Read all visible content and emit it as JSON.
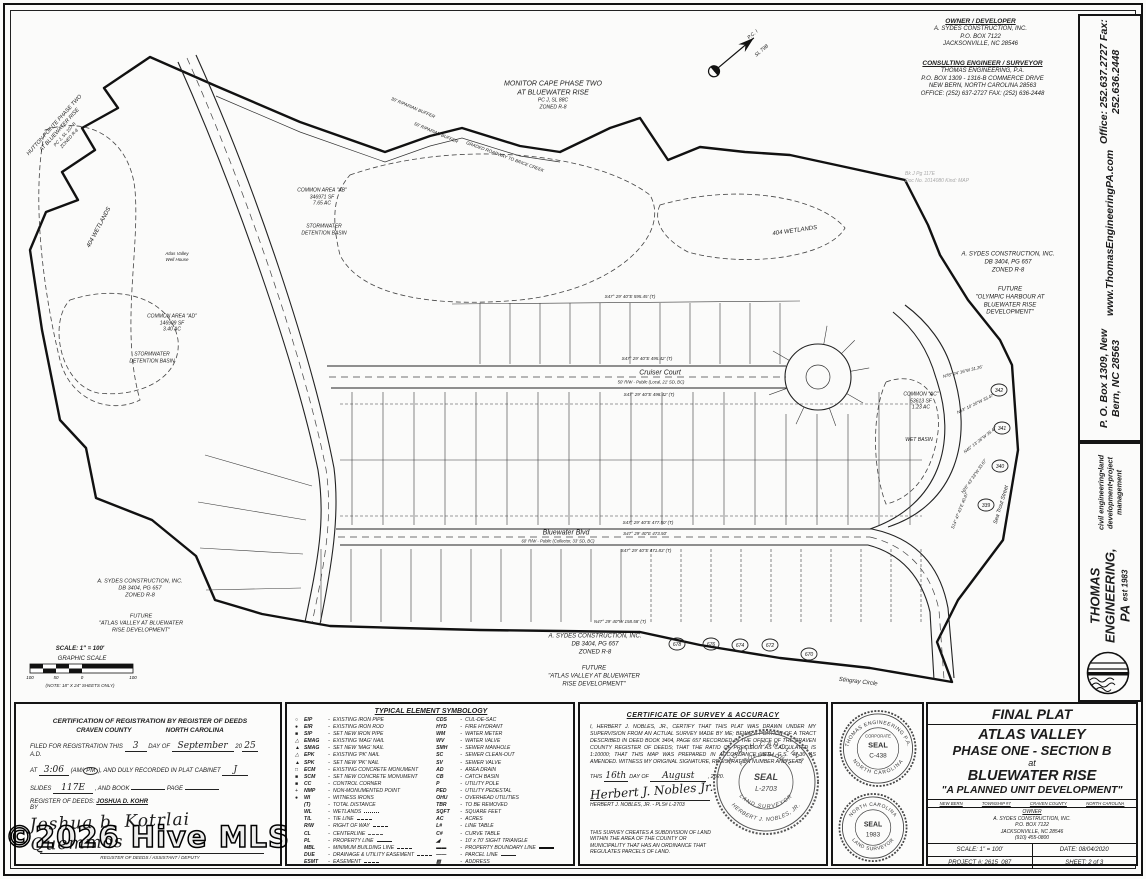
{
  "colors": {
    "ink": "#1c1c1c",
    "paper": "#fbfbfa",
    "faint": "#a9a9a9"
  },
  "watermark": "©2026 Hive MLS",
  "header": {
    "owner": {
      "heading": "OWNER / DEVELOPER",
      "lines": [
        "A. SYDES CONSTRUCTION, INC.",
        "P.O. BOX 7122",
        "JACKSONVILLE, NC 28546"
      ]
    },
    "engineer": {
      "heading": "CONSULTING ENGINEER / SURVEYOR",
      "lines": [
        "THOMAS ENGINEERING, P.A.",
        "P.O. BOX 1309 - 1316-B COMMERCE DRIVE",
        "NEW BERN, NORTH CAROLINA 28563",
        "OFFICE: (252) 637-2727   FAX: (252) 636-2448"
      ]
    },
    "stamp": {
      "line1": "Bk  J          Pg  117E",
      "line2": "Doc No. 1014080  Kind: MAP"
    }
  },
  "map": {
    "adjoiners": {
      "hutton": [
        "HUTTON POINTE PHASE TWO",
        "AT BLUEWATER RISE",
        "PC J, SL 107 B",
        "ZONED R-8"
      ],
      "monitor": [
        "MONITOR CAPE PHASE TWO",
        "AT BLUEWATER RISE",
        "PC J, SL 88C",
        "ZONED R-8"
      ]
    },
    "labels": {
      "wetlands": "404 WETLANDS",
      "common_ab": [
        "COMMON AREA \"AB\"",
        "346971 SF",
        "7.65 AC"
      ],
      "common_ad": [
        "COMMON AREA \"AD\"",
        "146909 SF",
        "3.40 AC"
      ],
      "common_ac": [
        "COMMON \"AC\"",
        "53613 SF",
        "1.23 AC"
      ],
      "stormwater": [
        "STORMWATER",
        "DETENTION BASIN"
      ],
      "wet_basin": "WET BASIN",
      "well_house": [
        "Atlas Valley",
        "Well House"
      ],
      "sydes": [
        "A. SYDES CONSTRUCTION, INC.",
        "DB 3404, PG 657",
        "ZONED R-8"
      ],
      "future_atlas": [
        "FUTURE",
        "\"ATLAS VALLEY AT BLUEWATER",
        "RISE DEVELOPMENT\""
      ],
      "future_olympic": [
        "FUTURE",
        "\"OLYMPIC HARBOUR AT",
        "BLUEWATER RISE",
        "DEVELOPMENT\""
      ],
      "riparian30": "30' RIPARIAN BUFFER",
      "riparian50": "50' RIPARIAN BUFFER",
      "brice": "GRADED ROADWAY TO BRICE CREEK",
      "pc": "P.C. I",
      "sl": "SL 79B"
    },
    "streets": {
      "cruiser": {
        "name": "Cruiser Court",
        "rw": "50' R/W - Public (Local, 21' SD, BC)",
        "bearing_top": "S47° 29' 40\"E   495.42' (T)",
        "bearing_bottom": "S47° 29' 40\"E   498.42' (T)"
      },
      "bluewater": {
        "name": "Bluewater Blvd",
        "rw": "60' R/W - Public (Collector, 33' SD, BC)",
        "bearing_top": "S47° 29' 40\"E   477.50' (T)",
        "bearing_mid": "S47° 29' 40\"E   473.50'",
        "bearing_bottom": "S47° 29' 40\"E   471.83' (T)"
      },
      "sea_trout": "Sea Trout Street",
      "stingray": "Stingray Circle"
    },
    "bearings": {
      "top_band": "S47° 29' 40\"E   595.45' (T)",
      "bottom_band": "N47° 29' 40\"W   158.58' (T)",
      "curve": [
        {
          "t": "N78° 24' 16\"W  31.26'",
          "x": 963,
          "y": 373,
          "r": -14
        },
        {
          "t": "N63° 10' 20\"W  33.47'",
          "x": 976,
          "y": 405,
          "r": -26
        },
        {
          "t": "N45° 13' 26\"W  35.47'",
          "x": 981,
          "y": 441,
          "r": -38
        },
        {
          "t": "N26° 43' 33\"W  33.67'",
          "x": 975,
          "y": 477,
          "r": -55
        },
        {
          "t": "S14° 47' 43\"E  40.87'",
          "x": 961,
          "y": 511,
          "r": -68
        }
      ]
    },
    "lots": {
      "right_curve": [
        {
          "n": "342",
          "x": 999,
          "y": 390
        },
        {
          "n": "341",
          "x": 1002,
          "y": 428
        },
        {
          "n": "340",
          "x": 1000,
          "y": 466
        },
        {
          "n": "339",
          "x": 986,
          "y": 505
        }
      ],
      "bottom_row": [
        {
          "n": "678",
          "x": 677,
          "y": 644
        },
        {
          "n": "676",
          "x": 711,
          "y": 644
        },
        {
          "n": "674",
          "x": 740,
          "y": 645
        },
        {
          "n": "672",
          "x": 770,
          "y": 645
        },
        {
          "n": "670",
          "x": 809,
          "y": 654
        }
      ]
    },
    "scale": {
      "text": "SCALE: 1\" = 100'",
      "caption": "GRAPHIC SCALE",
      "ticks": [
        "100",
        "50",
        "0",
        "100"
      ],
      "note": "(NOTE: 18\" X 24\" SHEETS ONLY)"
    }
  },
  "sidebar": {
    "contact": [
      "P. O. Box 1309, New Bern, NC  28563",
      "www.ThomasEngineeringPA.com",
      "Office:  252.637.2727   Fax:  252.636.2448"
    ],
    "firm": {
      "name": "THOMAS ENGINEERING, PA",
      "est": "est 1983",
      "tagline": "civil engineering•land development•project management"
    }
  },
  "registration": {
    "title": "CERTIFICATION OF REGISTRATION BY REGISTER OF DEEDS",
    "county": "CRAVEN COUNTY",
    "state": "NORTH CAROLINA",
    "filed_pre": "FILED FOR REGISTRATION THIS",
    "day": "3",
    "filed_mid": "DAY OF",
    "month": "September",
    "year_pre": "20",
    "year": "25",
    "ad": "A.D.",
    "at_label": "AT",
    "time": "3:06",
    "am": "AM",
    "pm": "PM",
    "recorded": "AND DULY RECORDED IN PLAT CABINET",
    "cabinet": "J",
    "slides_label": "SLIDES",
    "slides": "117E",
    "book_label": ", AND BOOK",
    "page_label": "PAGE",
    "rod_label": "REGISTER OF DEEDS:",
    "rod_name": "JOSHUA D. KOHR",
    "by": "BY",
    "signature": "Joshua b. Kotrlai Quemmos",
    "sig_caption": "REGISTER OF DEEDS / ASSISTANT / DEPUTY"
  },
  "legend": {
    "title": "TYPICAL ELEMENT SYMBOLOGY",
    "left": [
      {
        "sym": "○",
        "abbr": "EIP",
        "desc": "EXISTING IRON PIPE"
      },
      {
        "sym": "●",
        "abbr": "EIR",
        "desc": "EXISTING IRON ROD"
      },
      {
        "sym": "■",
        "abbr": "SIP",
        "desc": "SET NEW IRON PIPE"
      },
      {
        "sym": "△",
        "abbr": "EMAG",
        "desc": "EXISTING 'MAG' NAIL"
      },
      {
        "sym": "▲",
        "abbr": "SMAG",
        "desc": "SET NEW 'MAG' NAIL"
      },
      {
        "sym": "△",
        "abbr": "EPK",
        "desc": "EXISTING 'PK' NAIL"
      },
      {
        "sym": "▲",
        "abbr": "SPK",
        "desc": "SET NEW 'PK' NAIL"
      },
      {
        "sym": "□",
        "abbr": "ECM",
        "desc": "EXISTING CONCRETE MONUMENT"
      },
      {
        "sym": "■",
        "abbr": "SCM",
        "desc": "SET NEW CONCRETE MONUMENT"
      },
      {
        "sym": "■",
        "abbr": "CC",
        "desc": "CONTROL CORNER"
      },
      {
        "sym": "+",
        "abbr": "NMP",
        "desc": "NON-MONUMENTED POINT"
      },
      {
        "sym": "●",
        "abbr": "WI",
        "desc": "WITNESS IRONS"
      },
      {
        "sym": "",
        "abbr": "(T)",
        "desc": "TOTAL DISTANCE"
      },
      {
        "sym": "",
        "abbr": "WL",
        "desc": "WETLANDS",
        "ls": "dotted"
      },
      {
        "sym": "",
        "abbr": "T/L",
        "desc": "TIE LINE",
        "ls": "dashed"
      },
      {
        "sym": "",
        "abbr": "R/W",
        "desc": "RIGHT OF WAY",
        "ls": "dashed"
      },
      {
        "sym": "",
        "abbr": "CL",
        "desc": "CENTERLINE",
        "ls": "dashdot"
      },
      {
        "sym": "",
        "abbr": "PL",
        "desc": "PROPERTY LINE",
        "ls": "solid"
      },
      {
        "sym": "",
        "abbr": "MBL",
        "desc": "MINIMUM BUILDING LINE",
        "ls": "dashed"
      },
      {
        "sym": "",
        "abbr": "DUE",
        "desc": "DRAINAGE & UTILITY EASEMENT",
        "ls": "dashed"
      },
      {
        "sym": "",
        "abbr": "ESMT",
        "desc": "EASEMENT",
        "ls": "dashed"
      }
    ],
    "right": [
      {
        "abbr": "CDS",
        "desc": "CUL-DE-SAC"
      },
      {
        "abbr": "HYD",
        "desc": "FIRE HYDRANT"
      },
      {
        "abbr": "WM",
        "desc": "WATER METER"
      },
      {
        "abbr": "WV",
        "desc": "WATER VALVE"
      },
      {
        "abbr": "SMH",
        "desc": "SEWER MANHOLE"
      },
      {
        "abbr": "SC",
        "desc": "SEWER CLEAN-OUT"
      },
      {
        "abbr": "SV",
        "desc": "SEWER VALVE"
      },
      {
        "abbr": "AD",
        "desc": "AREA DRAIN"
      },
      {
        "abbr": "CB",
        "desc": "CATCH BASIN"
      },
      {
        "abbr": "P",
        "desc": "UTILITY POLE"
      },
      {
        "abbr": "PED",
        "desc": "UTILITY PEDESTAL"
      },
      {
        "abbr": "OHU",
        "desc": "OVERHEAD UTILITIES"
      },
      {
        "abbr": "TBR",
        "desc": "TO BE REMOVED"
      },
      {
        "abbr": "SQFT",
        "desc": "SQUARE FEET"
      },
      {
        "abbr": "AC",
        "desc": "ACRES"
      },
      {
        "abbr": "L#",
        "desc": "LINE TABLE"
      },
      {
        "abbr": "C#",
        "desc": "CURVE TABLE"
      },
      {
        "abbr": "◢",
        "desc": "10' x 70' SIGHT TRIANGLE"
      },
      {
        "abbr": "▬▬",
        "desc": "PROPERTY BOUNDARY LINE",
        "ls": "thick"
      },
      {
        "abbr": "——",
        "desc": "PARCEL LINE",
        "ls": "solid"
      },
      {
        "abbr": "▨",
        "desc": "ADDRESS"
      }
    ]
  },
  "certificate": {
    "title": "CERTIFICATE OF SURVEY & ACCURACY",
    "body": "I, HERBERT J. NOBLES, JR., CERTIFY THAT THIS PLAT WAS DRAWN UNDER MY SUPERVISION FROM AN ACTUAL SURVEY MADE BY ME; BEING A PORTION OF A TRACT DESCRIBED IN DEED BOOK 3404, PAGE 657 RECORDED IN THE OFFICE OF THE CRAVEN COUNTY REGISTER OF DEEDS; THAT THE RATIO OF PRECISION AS CALCULATED IS 1:10000; THAT THIS MAP WAS PREPARED IN ACCORDANCE WITH G.S. 47-30 AS AMENDED. WITNESS MY ORIGINAL SIGNATURE, REGISTRATION NUMBER AND SEAL,",
    "this": "THIS",
    "day": "16th",
    "day_of": "DAY OF",
    "month": "August",
    "year": ", 2020.",
    "signature": "Herbert J. Nobles Jr.",
    "sig_caption": "HERBERT J. NOBLES, JR.  -  PLS# L-2703",
    "footer": "THIS SURVEY CREATES A SUBDIVISION OF LAND WITHIN THE AREA OF THE COUNTY OR MUNICIPALITY THAT HAS AN ORDINANCE THAT REGULATES PARCELS OF LAND.",
    "seal": {
      "arc_top": "NORTH CAROLINA",
      "arc_top2": "PROFESSIONAL",
      "center1": "SEAL",
      "center2": "L-2703",
      "arc_bot2": "LAND SURVEYOR",
      "arc_bot": "HERBERT J. NOBLES, JR."
    }
  },
  "seals": {
    "corporate": {
      "ring_top": "THOMAS ENGINEERING P.A.",
      "ring_bottom": "NORTH CAROLINA",
      "inner": "CORPORATE",
      "center1": "SEAL",
      "center2": "C-438"
    },
    "surveyor": {
      "ring_top": "NORTH CAROLINA",
      "ring_bottom": "LAND SURVEYOR",
      "center1": "SEAL",
      "center2": "1983"
    }
  },
  "titleblock": {
    "final_plat": "FINAL PLAT",
    "name1": "ATLAS VALLEY",
    "name2": "PHASE ONE - SECTION B",
    "at": "at",
    "name3": "BLUEWATER RISE",
    "pud": "\"A PLANNED UNIT DEVELOPMENT\"",
    "loc": [
      "NEW BERN",
      "TOWNSHIP #7",
      "CRAVEN COUNTY",
      "NORTH CAROLINA"
    ],
    "owner_heading": "OWNER",
    "owner_lines": [
      "A. SYDES CONSTRUCTION, INC.",
      "P.O. BOX 7122",
      "JACKSONVILLE, NC 28546",
      "(910) 455-0800"
    ],
    "scale": "SCALE: 1\" = 100'",
    "date": "DATE: 08/04/2020",
    "project": "PROJECT #: 2615_087",
    "sheet": "SHEET: 2 of 3"
  }
}
